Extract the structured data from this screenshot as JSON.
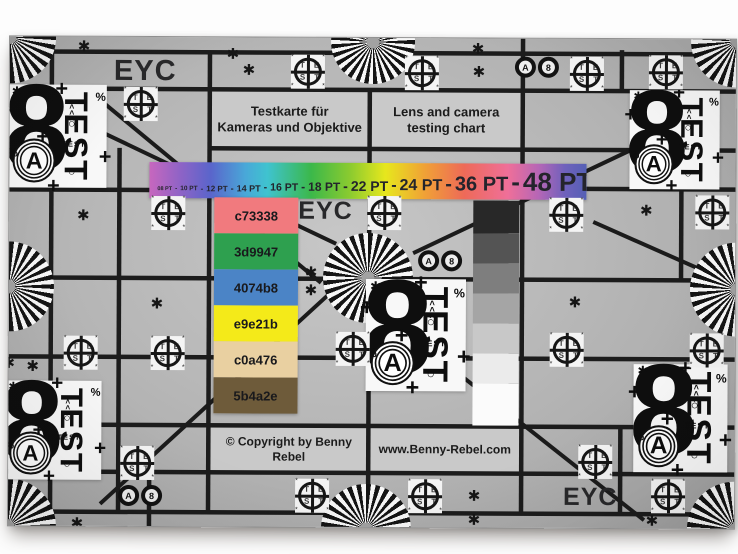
{
  "photo": {
    "background": "#fdfdfd"
  },
  "chart": {
    "eyc_label": "EYC",
    "title_de_line1": "Testkarte für",
    "title_de_line2": "Kameras und Objektive",
    "title_en_line1": "Lens and camera",
    "title_en_line2": "testing chart",
    "copyright": "© Copyright by Benny Rebel",
    "website": "www.Benny-Rebel.com",
    "background_tone": "#b5b5b5",
    "grid_color": "#1c1c1c"
  },
  "font_scale_bar": {
    "separator": "-",
    "items": [
      {
        "label": "08 PT",
        "px": 5.5
      },
      {
        "label": "10 PT",
        "px": 6.5
      },
      {
        "label": "12 PT",
        "px": 8
      },
      {
        "label": "14 PT",
        "px": 9
      },
      {
        "label": "16 PT",
        "px": 10.5
      },
      {
        "label": "18 PT",
        "px": 12
      },
      {
        "label": "22 PT",
        "px": 14
      },
      {
        "label": "24 PT",
        "px": 16
      },
      {
        "label": "36 PT",
        "px": 20
      },
      {
        "label": "48 PT",
        "px": 26
      }
    ],
    "gradient_stops": [
      "#c767be 0%",
      "#8f63c6 7%",
      "#5a65cb 14%",
      "#49a8d8 22%",
      "#3fc3cf 27%",
      "#3bb84a 37%",
      "#8ccb2f 46%",
      "#e7e71d 54%",
      "#f0a136 63%",
      "#ee6a58 72%",
      "#ef6f99 82%",
      "#b666b6 89%",
      "#6f61bc 95%",
      "#5560b5 100%"
    ]
  },
  "color_patches": [
    {
      "code": "c73338",
      "display": "#f17a7e"
    },
    {
      "code": "3d9947",
      "display": "#2ea04f"
    },
    {
      "code": "4074b8",
      "display": "#4b84c6"
    },
    {
      "code": "e9e21b",
      "display": "#f4ea19"
    },
    {
      "code": "c0a476",
      "display": "#e9d0a1"
    },
    {
      "code": "5b4a2e",
      "display": "#6e5b3a"
    }
  ],
  "grayscale_wedge": [
    "#282828",
    "#545454",
    "#7e7e7e",
    "#a5a5a5",
    "#c8c8c8",
    "#ebebeb",
    "#fbfbfb"
  ],
  "resolution_block": {
    "digit": "8",
    "ring_letter": "A",
    "vertical_word": "TEST",
    "small_word": "TEST",
    "plus": "+",
    "percent": "%",
    "arrows": "<<<",
    "circle": "○",
    "star": "✱"
  },
  "crosshair_target": {
    "top_letters": "TE",
    "bottom_letters": "ST",
    "corner_star": "*"
  },
  "star_glyph": "✱",
  "roundel": {
    "left_letter": "A",
    "right_digit": "8"
  }
}
